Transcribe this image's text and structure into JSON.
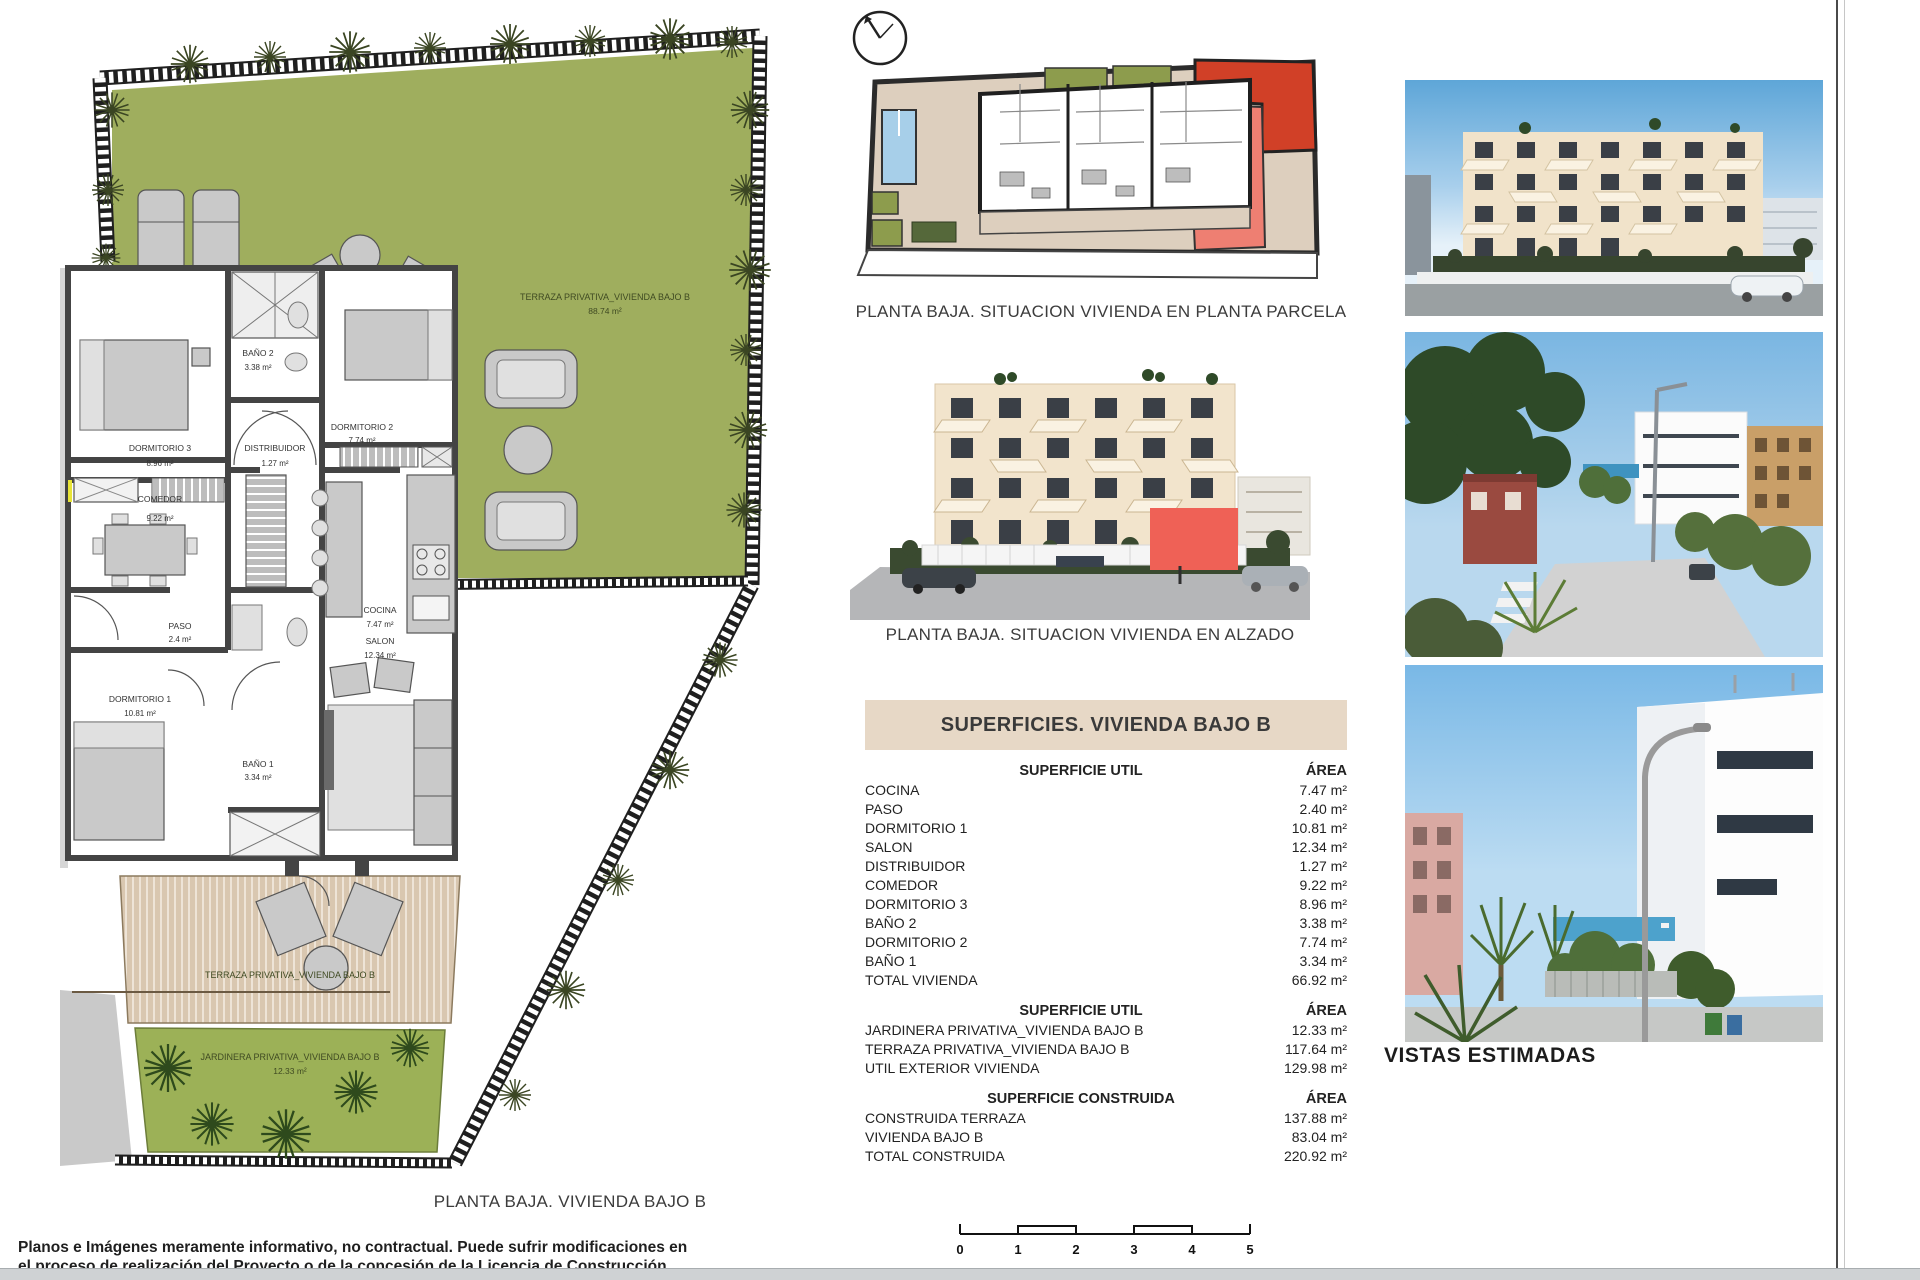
{
  "floor_plan": {
    "caption": "PLANTA BAJA. VIVIENDA BAJO B",
    "garden_label": {
      "name": "TERRAZA PRIVATIVA_VIVIENDA BAJO B",
      "area": "88.74 m²"
    },
    "deck_label": {
      "name": "TERRAZA PRIVATIVA_VIVIENDA BAJO B"
    },
    "jardinera_label": {
      "name": "JARDINERA PRIVATIVA_VIVIENDA BAJO B",
      "area": "12.33 m²"
    },
    "rooms": [
      {
        "name": "DORMITORIO 3",
        "area": "8.96 m²"
      },
      {
        "name": "BAÑO 2",
        "area": "3.38 m²"
      },
      {
        "name": "DISTRIBUIDOR",
        "area": "1.27 m²"
      },
      {
        "name": "DORMITORIO 2",
        "area": "7.74 m²"
      },
      {
        "name": "COMEDOR",
        "area": "9.22 m²"
      },
      {
        "name": "COCINA",
        "area": "7.47 m²"
      },
      {
        "name": "PASO",
        "area": "2.4 m²"
      },
      {
        "name": "SALON",
        "area": "12.34 m²"
      },
      {
        "name": "DORMITORIO 1",
        "area": "10.81 m²"
      },
      {
        "name": "BAÑO 1",
        "area": "3.34 m²"
      }
    ]
  },
  "site_plan": {
    "caption": "PLANTA BAJA. SITUACION VIVIENDA EN PLANTA PARCELA",
    "compass_icon": "compass-dial"
  },
  "elevation": {
    "caption": "PLANTA BAJA. SITUACION VIVIENDA EN ALZADO"
  },
  "surfaces": {
    "title": "SUPERFICIES. VIVIENDA BAJO B",
    "sections": [
      {
        "header": "SUPERFICIE UTIL",
        "area_col": "ÁREA",
        "rows": [
          {
            "label": "COCINA",
            "value": "7.47 m²"
          },
          {
            "label": "PASO",
            "value": "2.40 m²"
          },
          {
            "label": "DORMITORIO 1",
            "value": "10.81 m²"
          },
          {
            "label": "SALON",
            "value": "12.34 m²"
          },
          {
            "label": "DISTRIBUIDOR",
            "value": "1.27 m²"
          },
          {
            "label": "COMEDOR",
            "value": "9.22 m²"
          },
          {
            "label": "DORMITORIO 3",
            "value": "8.96 m²"
          },
          {
            "label": "BAÑO 2",
            "value": "3.38 m²"
          },
          {
            "label": "DORMITORIO 2",
            "value": "7.74 m²"
          },
          {
            "label": "BAÑO 1",
            "value": "3.34 m²"
          },
          {
            "label": "TOTAL VIVIENDA",
            "value": "66.92 m²"
          }
        ]
      },
      {
        "header": "SUPERFICIE UTIL",
        "area_col": "ÁREA",
        "rows": [
          {
            "label": "JARDINERA PRIVATIVA_VIVIENDA BAJO B",
            "value": "12.33 m²"
          },
          {
            "label": "TERRAZA PRIVATIVA_VIVIENDA BAJO B",
            "value": "117.64 m²"
          },
          {
            "label": "UTIL EXTERIOR VIVIENDA",
            "value": "129.98 m²"
          }
        ]
      },
      {
        "header": "SUPERFICIE CONSTRUIDA",
        "area_col": "ÁREA",
        "rows": [
          {
            "label": "CONSTRUIDA TERRAZA",
            "value": "137.88 m²"
          },
          {
            "label": "VIVIENDA BAJO B",
            "value": "83.04 m²"
          },
          {
            "label": "TOTAL CONSTRUIDA",
            "value": "220.92 m²"
          }
        ]
      }
    ]
  },
  "vistas": {
    "title": "VISTAS ESTIMADAS"
  },
  "scale_bar": {
    "ticks": [
      "0",
      "1",
      "2",
      "3",
      "4",
      "5"
    ]
  },
  "disclaimer": {
    "line1": "Planos e Imágenes meramente informativo, no contractual. Puede sufrir modificaciones en",
    "line2": "el proceso de realización del Proyecto o de la concesión de la Licencia de Construcción."
  },
  "colors": {
    "garden_green": "#9fae5e",
    "jardinera_green": "#9cb157",
    "deck_tan": "#d9c7b0",
    "table_header_beige": "#e7d8c6",
    "unit_red": "#d14027",
    "unit_pink": "#ee7f72",
    "highlight_red": "#ef6156",
    "pool_blue": "#a7cfe9"
  }
}
